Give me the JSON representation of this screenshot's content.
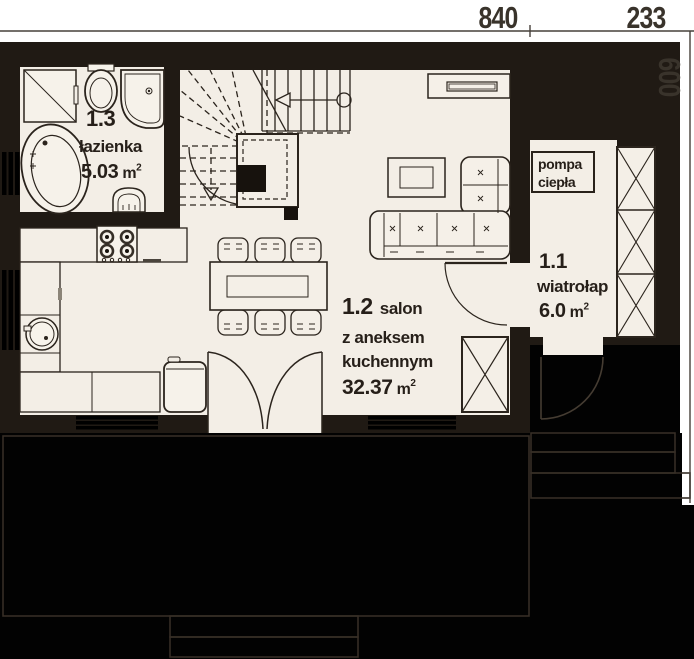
{
  "dimensions": {
    "top": [
      {
        "value": "840"
      },
      {
        "value": "233"
      }
    ],
    "right": [
      {
        "value": "600"
      }
    ]
  },
  "rooms": [
    {
      "number": "1.3",
      "name": "łazienka",
      "area": "5.03",
      "area_unit": "m",
      "area_exp": "2"
    },
    {
      "number": "1.2",
      "name": "salon",
      "name_line2": "z aneksem",
      "name_line3": "kuchennym",
      "area": "32.37",
      "area_unit": "m",
      "area_exp": "2"
    },
    {
      "number": "1.1",
      "name": "wiatrołap",
      "area": "6.0",
      "area_unit": "m",
      "area_exp": "2"
    }
  ],
  "equipment": {
    "heat_pump": {
      "line1": "pompa",
      "line2": "ciepła"
    }
  },
  "colors": {
    "floor": "#f3eee6",
    "wall": "#201a14",
    "outside": "#020202",
    "line": "#2b241d",
    "text": "#261f19",
    "dim_text": "#39332b"
  },
  "fixtures": [
    "corner-bathtub",
    "toilet",
    "corner-shower",
    "washing-machine",
    "washbasin",
    "winder-staircase",
    "chimney",
    "cooktop",
    "kitchen-counter",
    "kitchen-sink",
    "fridge",
    "dining-table",
    "chair",
    "corner-sofa",
    "coffee-table",
    "tv-cabinet",
    "wardrobe",
    "hall-closet",
    "french-door",
    "interior-door",
    "entrance-door",
    "window",
    "terrace",
    "entry-steps"
  ]
}
